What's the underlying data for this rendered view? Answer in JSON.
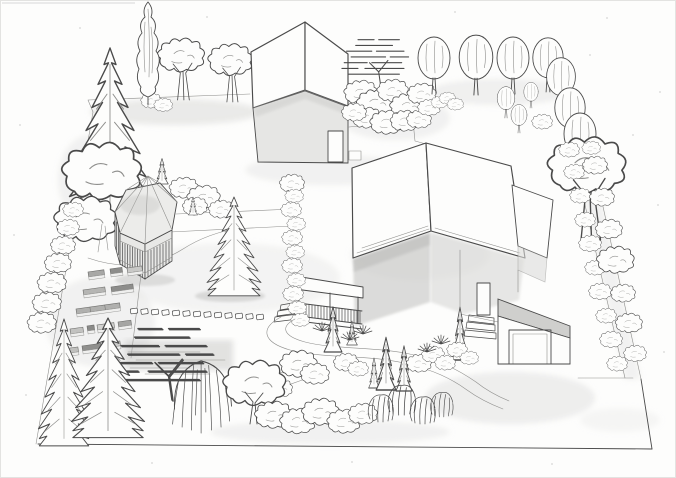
{
  "scene": {
    "title": "Hand-drawn pencil perspective sketch of a landscaped residential garden plot",
    "medium": "graphite pencil line drawing with soft shading on white paper",
    "view": "aerial three-quarter perspective, no text or labels in the drawing",
    "colors": {
      "paper": "#fdfdfc",
      "ink": "#4a4a4a",
      "ink-light": "#8f8f8d",
      "wash": "#d8d8d6",
      "wash-dark": "#b9b9b7",
      "panel": "#ececea"
    },
    "buildings": [
      {
        "name": "main-house",
        "features": "large white hipped roof, shaded walls, front porch with balustrade and steps, side stair block"
      },
      {
        "name": "guest-house",
        "features": "steep white gable roof, shaded gable wall, small door"
      },
      {
        "name": "garage",
        "features": "mono-pitched shaded roof, wide door, entry steps"
      },
      {
        "name": "gazebo",
        "features": "hexagonal faceted roof, slatted balustrade walls"
      }
    ],
    "vegetation": [
      "tall spruce top-left",
      "columnar poplar",
      "serrated deciduous trees top-left",
      "row of round-crown trees along top-right boundary",
      "multi-stem tree on right border",
      "shrub strip along right boundary",
      "flat-topped hatched pines (top-center and bottom-left)",
      "large spruce in center lawn",
      "two large spruces bottom-left",
      "weeping willow",
      "round bushy tree",
      "juniper cones along front path",
      "cloud shrubs and bottom hedge",
      "left boundary shrub chain",
      "climbing vine at house corner",
      "grass tufts"
    ],
    "hardscape": [
      "vegetable garden raised beds",
      "stepping-stone path",
      "straight path from gazebo to house",
      "winding front path",
      "driveway in front of garage",
      "property boundary lines"
    ]
  }
}
